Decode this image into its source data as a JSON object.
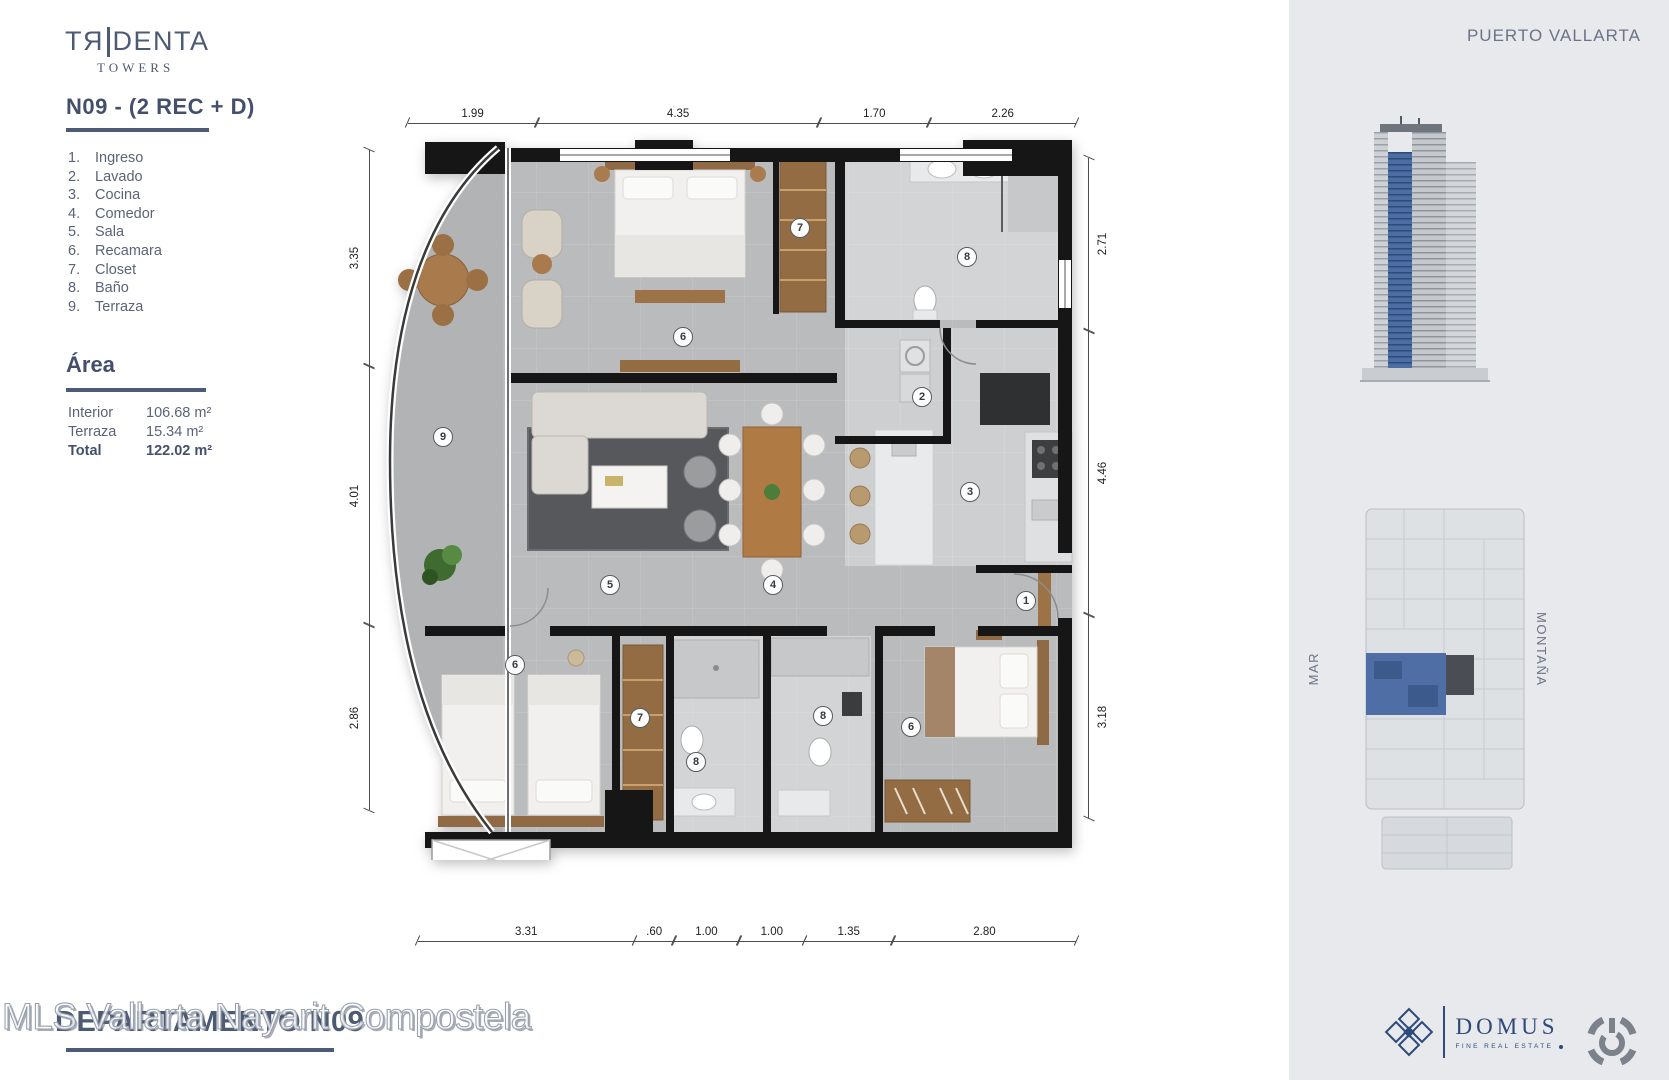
{
  "brand": {
    "part1": "TЯ",
    "part2": "DENTA",
    "sub": "TOWERS"
  },
  "unit": {
    "title": "N09 - (2 REC + D)"
  },
  "legend": [
    {
      "n": "1.",
      "label": "Ingreso"
    },
    {
      "n": "2.",
      "label": "Lavado"
    },
    {
      "n": "3.",
      "label": "Cocina"
    },
    {
      "n": "4.",
      "label": "Comedor"
    },
    {
      "n": "5.",
      "label": "Sala"
    },
    {
      "n": "6.",
      "label": "Recamara"
    },
    {
      "n": "7.",
      "label": "Closet"
    },
    {
      "n": "8.",
      "label": "Baño"
    },
    {
      "n": "9.",
      "label": "Terraza"
    }
  ],
  "area": {
    "heading": "Área",
    "rows": [
      {
        "label": "Interior",
        "value": "106.68 m²",
        "bold": false
      },
      {
        "label": "Terraza",
        "value": "15.34 m²",
        "bold": false
      },
      {
        "label": "Total",
        "value": "122.02 m²",
        "bold": true
      }
    ]
  },
  "floorplan": {
    "dims_top": [
      "1.99",
      "4.35",
      "1.70",
      "2.26"
    ],
    "dims_bottom": [
      "3.31",
      ".60",
      "1.00",
      "1.00",
      "1.35",
      "2.80"
    ],
    "dims_left": [
      "3.35",
      "4.01",
      "2.86"
    ],
    "dims_right": [
      "2.71",
      "4.46",
      "3.18"
    ],
    "markers": [
      {
        "n": "9",
        "x": 63,
        "y": 297
      },
      {
        "n": "6",
        "x": 303,
        "y": 197
      },
      {
        "n": "7",
        "x": 420,
        "y": 88
      },
      {
        "n": "8",
        "x": 587,
        "y": 117
      },
      {
        "n": "2",
        "x": 542,
        "y": 257
      },
      {
        "n": "3",
        "x": 590,
        "y": 352
      },
      {
        "n": "5",
        "x": 230,
        "y": 445
      },
      {
        "n": "4",
        "x": 393,
        "y": 445
      },
      {
        "n": "1",
        "x": 646,
        "y": 461
      },
      {
        "n": "6",
        "x": 135,
        "y": 525
      },
      {
        "n": "7",
        "x": 260,
        "y": 578
      },
      {
        "n": "8",
        "x": 316,
        "y": 622
      },
      {
        "n": "8",
        "x": 443,
        "y": 576
      },
      {
        "n": "6",
        "x": 531,
        "y": 587
      }
    ]
  },
  "sidebar": {
    "location": "PUERTO VALLARTA",
    "label_sea": "MAR",
    "label_mountain": "MONTAÑA"
  },
  "logos": {
    "domus": "DOMUS",
    "domus_tagline": "FINE REAL ESTATE"
  },
  "footer": {
    "overlay_bold": "DEPARTAMENTO N09",
    "watermark": "MLS Vallarta Nayarit Compostela"
  },
  "colors": {
    "navy": "#4d5a74",
    "sidebar_bg": "#e7e9ec",
    "unit_blue": "#4f6ea6"
  }
}
